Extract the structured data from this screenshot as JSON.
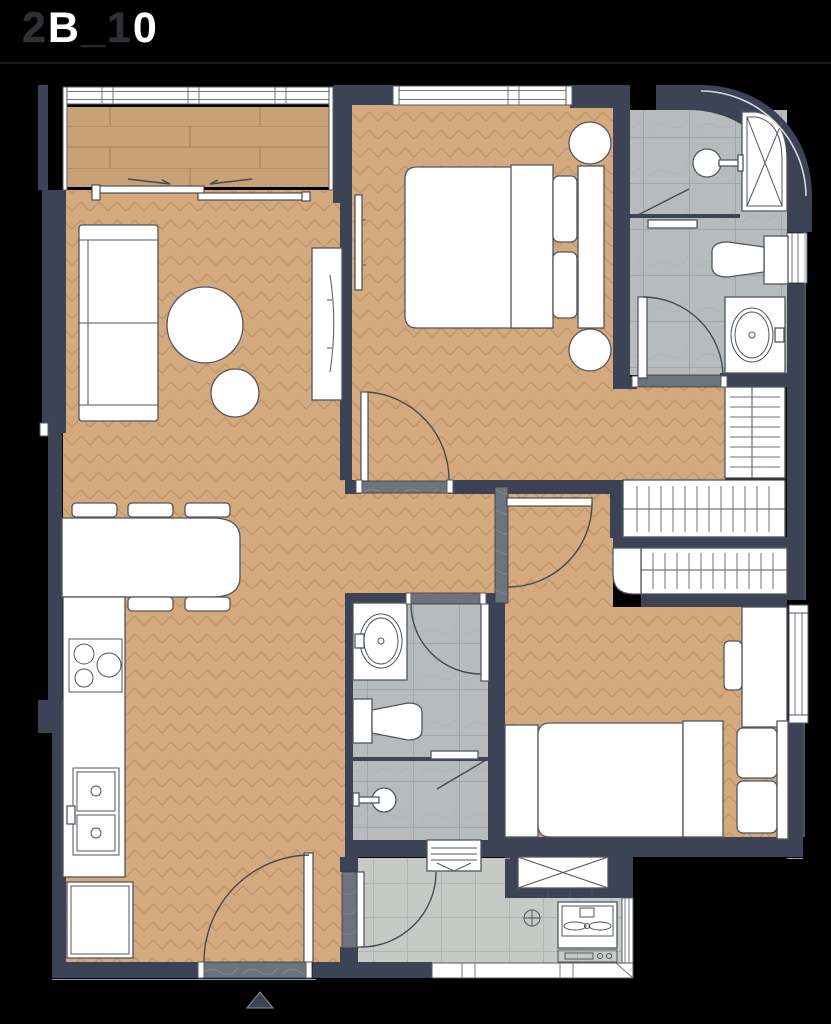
{
  "header": {
    "title": "2B_10",
    "title_char_colors": [
      "#2f3033",
      "#ffffff",
      "#2f3033",
      "#2f3033",
      "#ffffff"
    ],
    "divider_color": "#1a1a1a"
  },
  "palette": {
    "background": "#000000",
    "wall": "#3c4355",
    "wood": "#d4a97e",
    "wood_line": "#bb9166",
    "plank": "#c9a176",
    "plank_line": "#a37c54",
    "tile": "#b8bbbc",
    "tile_line": "#a3a6a8",
    "tile_light": "#c7c9c6",
    "tile_light_line": "#b2b4b1",
    "marble": "#6d737b",
    "marble_line": "#8a9099",
    "furniture_fill": "#ffffff",
    "furniture_line": "#51565c",
    "door_line": "#454a52",
    "highlight": "#d7dade"
  },
  "icons": {
    "entry_marker": "triangle-up"
  }
}
